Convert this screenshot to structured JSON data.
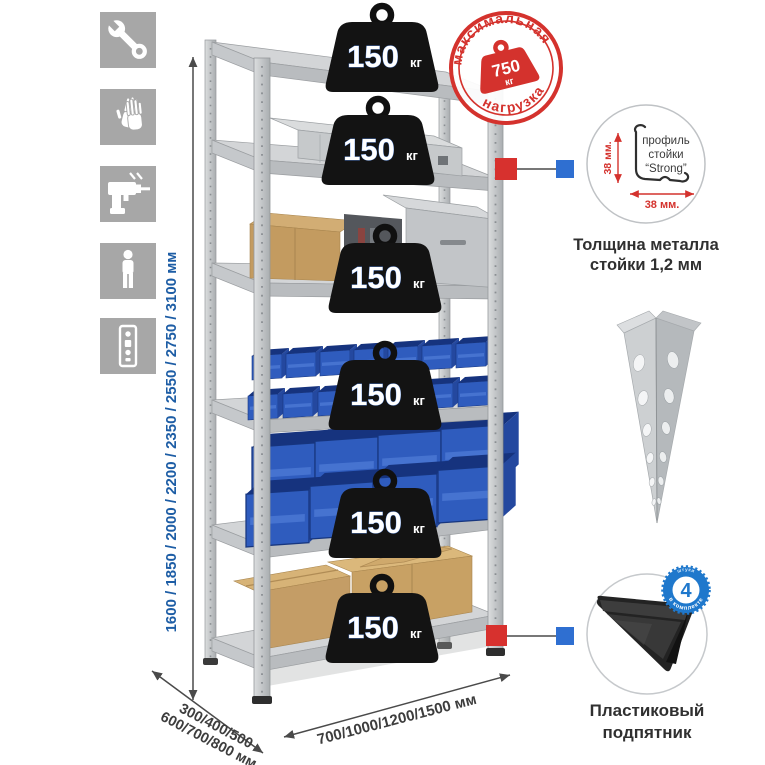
{
  "sidebar": {
    "icons": [
      {
        "name": "wrench-icon"
      },
      {
        "name": "gloves-icon"
      },
      {
        "name": "drill-icon"
      },
      {
        "name": "person-icon"
      },
      {
        "name": "perforated-profile-icon"
      }
    ]
  },
  "dims": {
    "height": "1600 / 1850 / 2000 / 2200 / 2350 / 2550 / 2750 / 3100 мм",
    "depth1": "300/400/500",
    "depth2": "600/700/800 мм",
    "width": "700/1000/1200/1500 мм"
  },
  "stamp": {
    "top": "максимальная",
    "bottom": "нагрузка",
    "value": "750",
    "unit": "кг"
  },
  "rack": {
    "shelves": [
      {
        "load": "150",
        "unit": "кг"
      },
      {
        "load": "150",
        "unit": "кг"
      },
      {
        "load": "150",
        "unit": "кг"
      },
      {
        "load": "150",
        "unit": "кг"
      },
      {
        "load": "150",
        "unit": "кг"
      },
      {
        "load": "150",
        "unit": "кг"
      }
    ]
  },
  "profile_detail": {
    "line1": "профиль",
    "line2": "стойки",
    "line3": "“Strong”",
    "dim_v": "38 мм.",
    "dim_h": "38 мм.",
    "caption1": "Толщина металла",
    "caption2": "стойки 1,2 мм"
  },
  "foot_detail": {
    "badge_value": "4",
    "badge_small": "штуки",
    "badge_arc": "в комплекте",
    "caption1": "Пластиковый",
    "caption2": "подпятник"
  },
  "colors": {
    "accent_red": "#d4322d",
    "accent_blue": "#1d5da5",
    "badge_blue": "#1f78cc",
    "bin_blue": "#2f5cbe",
    "metal_gray": "#c9ccce"
  }
}
